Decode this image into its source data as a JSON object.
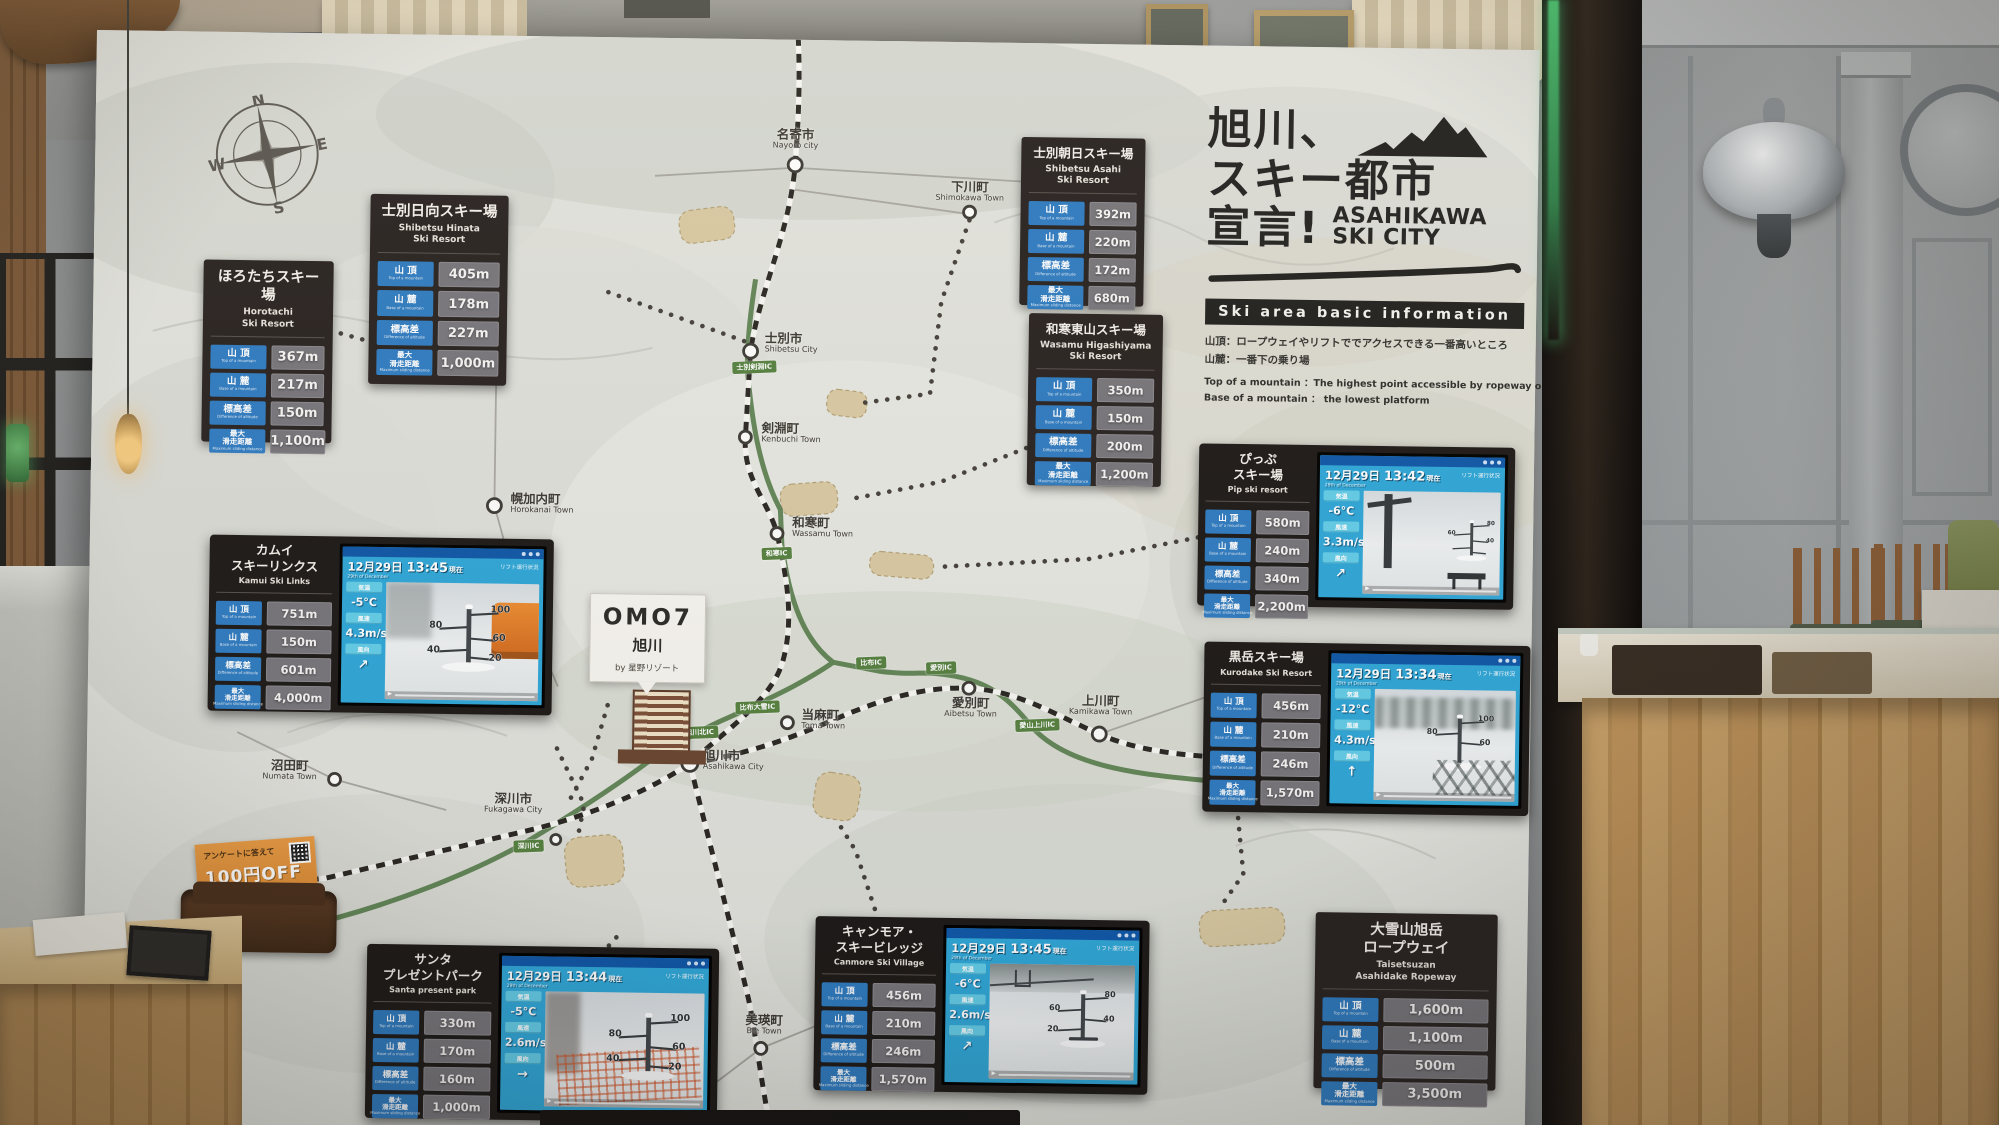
{
  "scene": {
    "compass": {
      "n": "N",
      "e": "E",
      "s": "S",
      "w": "W"
    }
  },
  "title": {
    "jp1": "旭川、",
    "jp2": "スキー都市",
    "jp3": "宣言!",
    "en": "ASAHIKAWA\nSKI CITY",
    "bar": "Ski area basic information",
    "note_jp1": "山頂：ロープウェイやリフトででアクセスできる一番高いところ",
    "note_jp2": "山麓：一番下の乗り場",
    "note_en1": "Top of a mountain ：The highest point accessible by ropeway or lift",
    "note_en2": "Base of a mountain ： the lowest platform"
  },
  "row_labels": [
    {
      "jp": "山 頂",
      "en": "Top of a mountain"
    },
    {
      "jp": "山 麓",
      "en": "Base of a mountain"
    },
    {
      "jp": "標高差",
      "en": "Difference of altitude"
    },
    {
      "jp": "最大\n滑走距離",
      "en": "Maximum sliding distance"
    }
  ],
  "screens_common": {
    "date": "12月29日",
    "suffix": "現在",
    "date_sub": "29th of December",
    "temp_label": "気温",
    "wind_label": "風速",
    "dir_label": "風向",
    "note": "リフト運行状況",
    "play": "▶"
  },
  "resorts": [
    {
      "name_jp": "ほろたちスキー場",
      "name_en": "Horotachi\nSki Resort",
      "values": [
        "367m",
        "217m",
        "150m",
        "1,100m"
      ]
    },
    {
      "name_jp": "士別日向スキー場",
      "name_en": "Shibetsu Hinata\nSki Resort",
      "values": [
        "405m",
        "178m",
        "227m",
        "1,000m"
      ]
    },
    {
      "name_jp": "士別朝日スキー場",
      "name_en": "Shibetsu Asahi\nSki Resort",
      "values": [
        "392m",
        "220m",
        "172m",
        "680m"
      ]
    },
    {
      "name_jp": "和寒東山スキー場",
      "name_en": "Wasamu Higashiyama\nSki Resort",
      "values": [
        "350m",
        "150m",
        "200m",
        "1,200m"
      ]
    },
    {
      "name_jp": "ぴっぷ\nスキー場",
      "name_en": "Pip ski resort",
      "values": [
        "580m",
        "240m",
        "340m",
        "2,200m"
      ],
      "screen": {
        "time": "13:42",
        "temp": "-6°C",
        "wind": "3.3m/s",
        "dir": "↗",
        "gauge": [
          "80",
          "60",
          "40",
          "",
          ""
        ]
      }
    },
    {
      "name_jp": "カムイ\nスキーリンクス",
      "name_en": "Kamui Ski Links",
      "values": [
        "751m",
        "150m",
        "601m",
        "4,000m"
      ],
      "screen": {
        "time": "13:45",
        "temp": "-5°C",
        "wind": "4.3m/s",
        "dir": "↗",
        "gauge": [
          "100",
          "80",
          "60",
          "40",
          "20"
        ]
      }
    },
    {
      "name_jp": "黒岳スキー場",
      "name_en": "Kurodake Ski Resort",
      "values": [
        "456m",
        "210m",
        "246m",
        "1,570m"
      ],
      "screen": {
        "time": "13:34",
        "temp": "-12°C",
        "wind": "4.3m/s",
        "dir": "↑",
        "gauge": [
          "100",
          "80",
          "60",
          "",
          ""
        ]
      }
    },
    {
      "name_jp": "サンタ\nプレゼントパーク",
      "name_en": "Santa present park",
      "values": [
        "330m",
        "170m",
        "160m",
        "1,000m"
      ],
      "screen": {
        "time": "13:44",
        "temp": "-5°C",
        "wind": "2.6m/s",
        "dir": "→",
        "gauge": [
          "100",
          "80",
          "60",
          "40",
          "20"
        ]
      }
    },
    {
      "name_jp": "キャンモア・\nスキービレッジ",
      "name_en": "Canmore Ski Village",
      "values": [
        "456m",
        "210m",
        "246m",
        "1,570m"
      ],
      "screen": {
        "time": "13:45",
        "temp": "-6°C",
        "wind": "2.6m/s",
        "dir": "↗",
        "gauge": [
          "80",
          "60",
          "40",
          "20",
          ""
        ]
      }
    },
    {
      "name_jp": "大雪山旭岳\nロープウェイ",
      "name_en": "Taisetsuzan\nAsahidake Ropeway",
      "values": [
        "1,600m",
        "1,100m",
        "500m",
        "3,500m"
      ]
    }
  ],
  "omo": {
    "brand": "OMO7",
    "city": "旭川",
    "by": "by 星野リゾート"
  },
  "coupon": {
    "line1": "アンケートに答えて",
    "line2": "100円OFF",
    "line3": "クーポン"
  },
  "towns": [
    {
      "jp": "名寄市",
      "en": "Nayoro city"
    },
    {
      "jp": "下川町",
      "en": "Shimokawa Town"
    },
    {
      "jp": "士別市",
      "en": "Shibetsu City"
    },
    {
      "jp": "剣淵町",
      "en": "Kenbuchi Town"
    },
    {
      "jp": "幌加内町",
      "en": "Horokanai Town"
    },
    {
      "jp": "和寒町",
      "en": "Wassamu Town"
    },
    {
      "jp": "愛別町",
      "en": "Aibetsu Town"
    },
    {
      "jp": "上川町",
      "en": "Kamikawa Town"
    },
    {
      "jp": "当麻町",
      "en": "Toma Town"
    },
    {
      "jp": "旭川市",
      "en": "Asahikawa City"
    },
    {
      "jp": "沼田町",
      "en": "Numata Town"
    },
    {
      "jp": "深川市",
      "en": "Fukagawa City"
    },
    {
      "jp": "美瑛町",
      "en": "Bie Town"
    }
  ],
  "ics": [
    "士別剣淵IC",
    "和寒IC",
    "比布IC",
    "愛別IC",
    "愛山上川IC",
    "比布大雪IC",
    "旭川北IC",
    "深川IC"
  ]
}
